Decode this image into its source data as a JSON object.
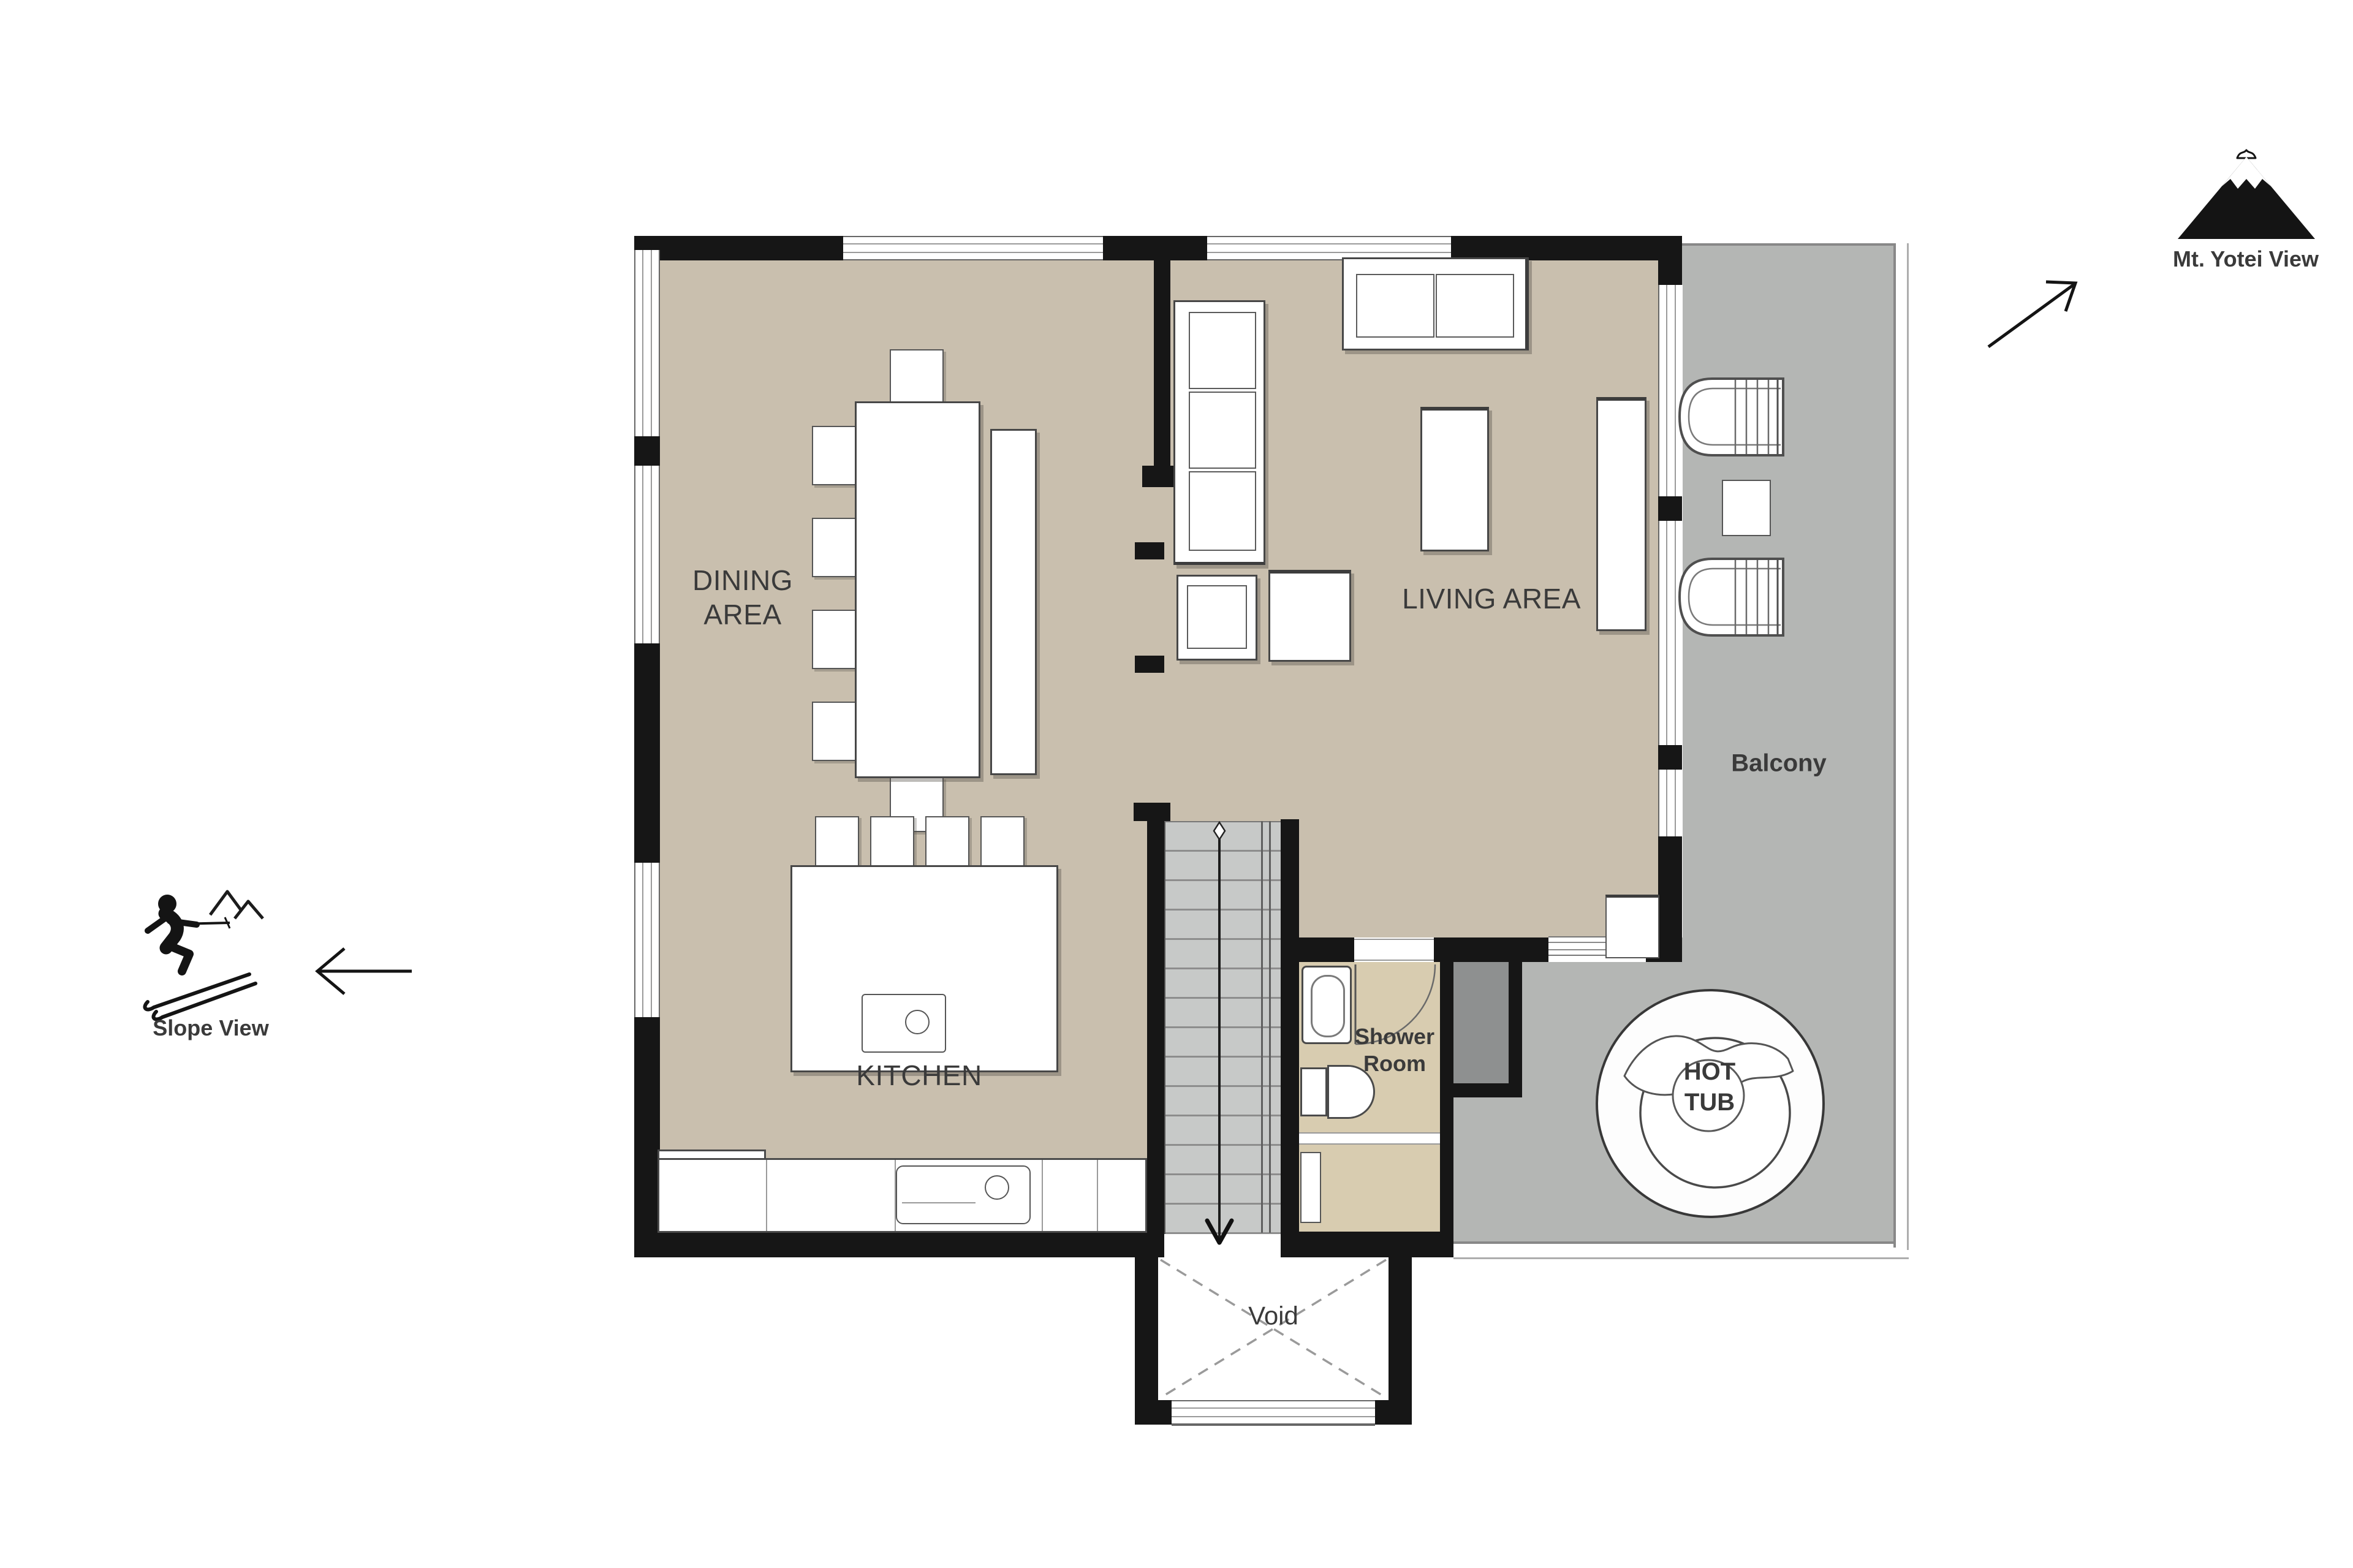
{
  "rooms": {
    "dining": {
      "lines": [
        "DINING",
        "AREA"
      ]
    },
    "living": {
      "label": "LIVING AREA"
    },
    "kitchen": {
      "label": "KITCHEN"
    },
    "balcony": {
      "label": "Balcony"
    },
    "shower": {
      "lines": [
        "Shower",
        "Room"
      ]
    },
    "hot_tub": {
      "lines": [
        "HOT",
        "TUB"
      ]
    },
    "void": {
      "label": "Void"
    }
  },
  "annotations": {
    "slope_view": {
      "label": "Slope View"
    },
    "yotei_view": {
      "label": "Mt. Yotei View"
    }
  },
  "icons": {
    "skier": "skier-icon",
    "mountain": "mt-yotei-icon",
    "slope_arrow": "arrow-left",
    "yotei_arrow": "arrow-up-right",
    "stairs_arrow": "arrow-down",
    "door_swing": "door-arc"
  },
  "colors": {
    "wall": "#161616",
    "floor": "#c9bfae",
    "shower_floor": "#d8ccb0",
    "balcony": "#b4b6b4",
    "closet": "#8e9090",
    "stairs": "#c7c9c8",
    "label_text": "#3a3a3a"
  }
}
